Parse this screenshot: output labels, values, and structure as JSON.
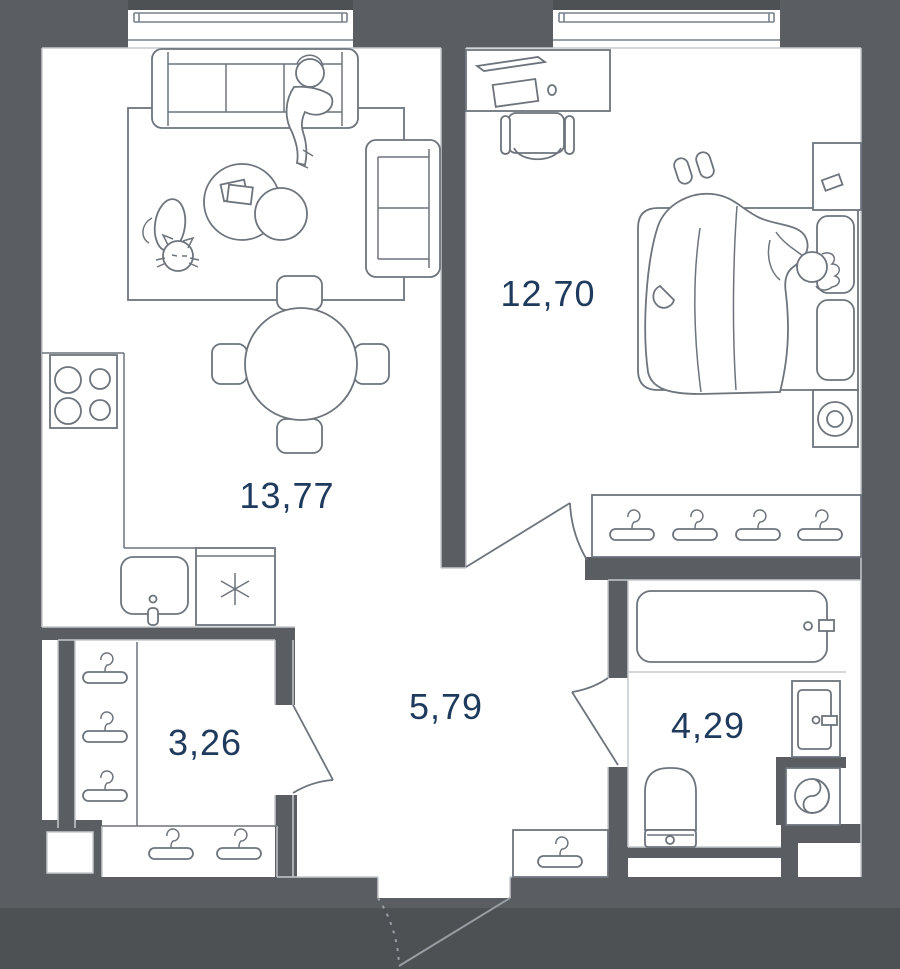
{
  "plan": {
    "rooms": [
      {
        "id": "living-kitchen",
        "area": "13,77"
      },
      {
        "id": "bedroom",
        "area": "12,70"
      },
      {
        "id": "hallway",
        "area": "5,79"
      },
      {
        "id": "wardrobe",
        "area": "3,26"
      },
      {
        "id": "bathroom",
        "area": "4,29"
      }
    ],
    "symbols": {
      "dishwasher": "✳"
    },
    "colors": {
      "wall": "#5a5e62",
      "outside": "#4e5154",
      "floor": "#ffffff",
      "furniture_line": "#6d747c",
      "label_text": "#1e3a5c"
    }
  }
}
